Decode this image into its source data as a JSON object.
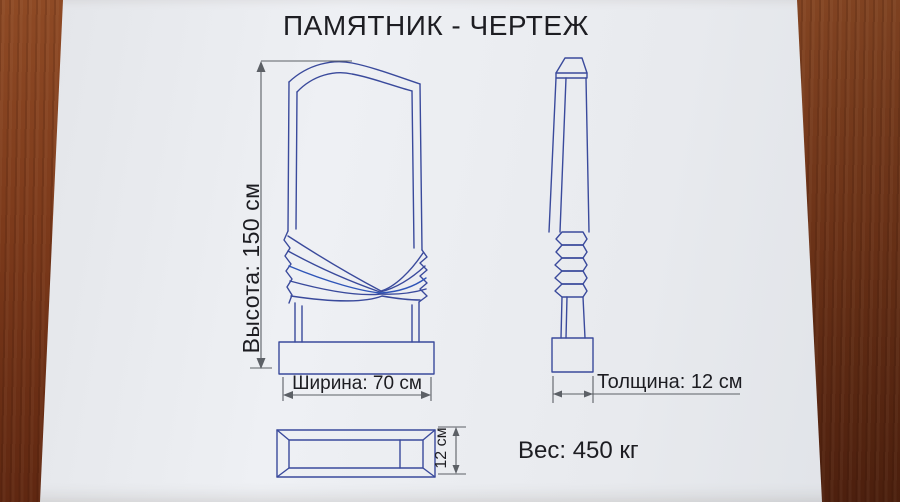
{
  "header": {
    "title": "ПАМЯТНИК - ЧЕРТЕЖ"
  },
  "front_view": {
    "height_label": "Высота: 150 см",
    "width_label": "Ширина: 70 см"
  },
  "side_view": {
    "thickness_label": "Толщина: 12 см"
  },
  "base_plate_view": {
    "thickness_label": "12 см"
  },
  "footer": {
    "weight_label": "Вес: 450 кг"
  },
  "colors": {
    "drawing_line": "#3a4a9c",
    "dimension_line": "#5c6066",
    "text_color": "#1d1d22",
    "paper": "#e9ebef",
    "wood": "#7a3819"
  }
}
